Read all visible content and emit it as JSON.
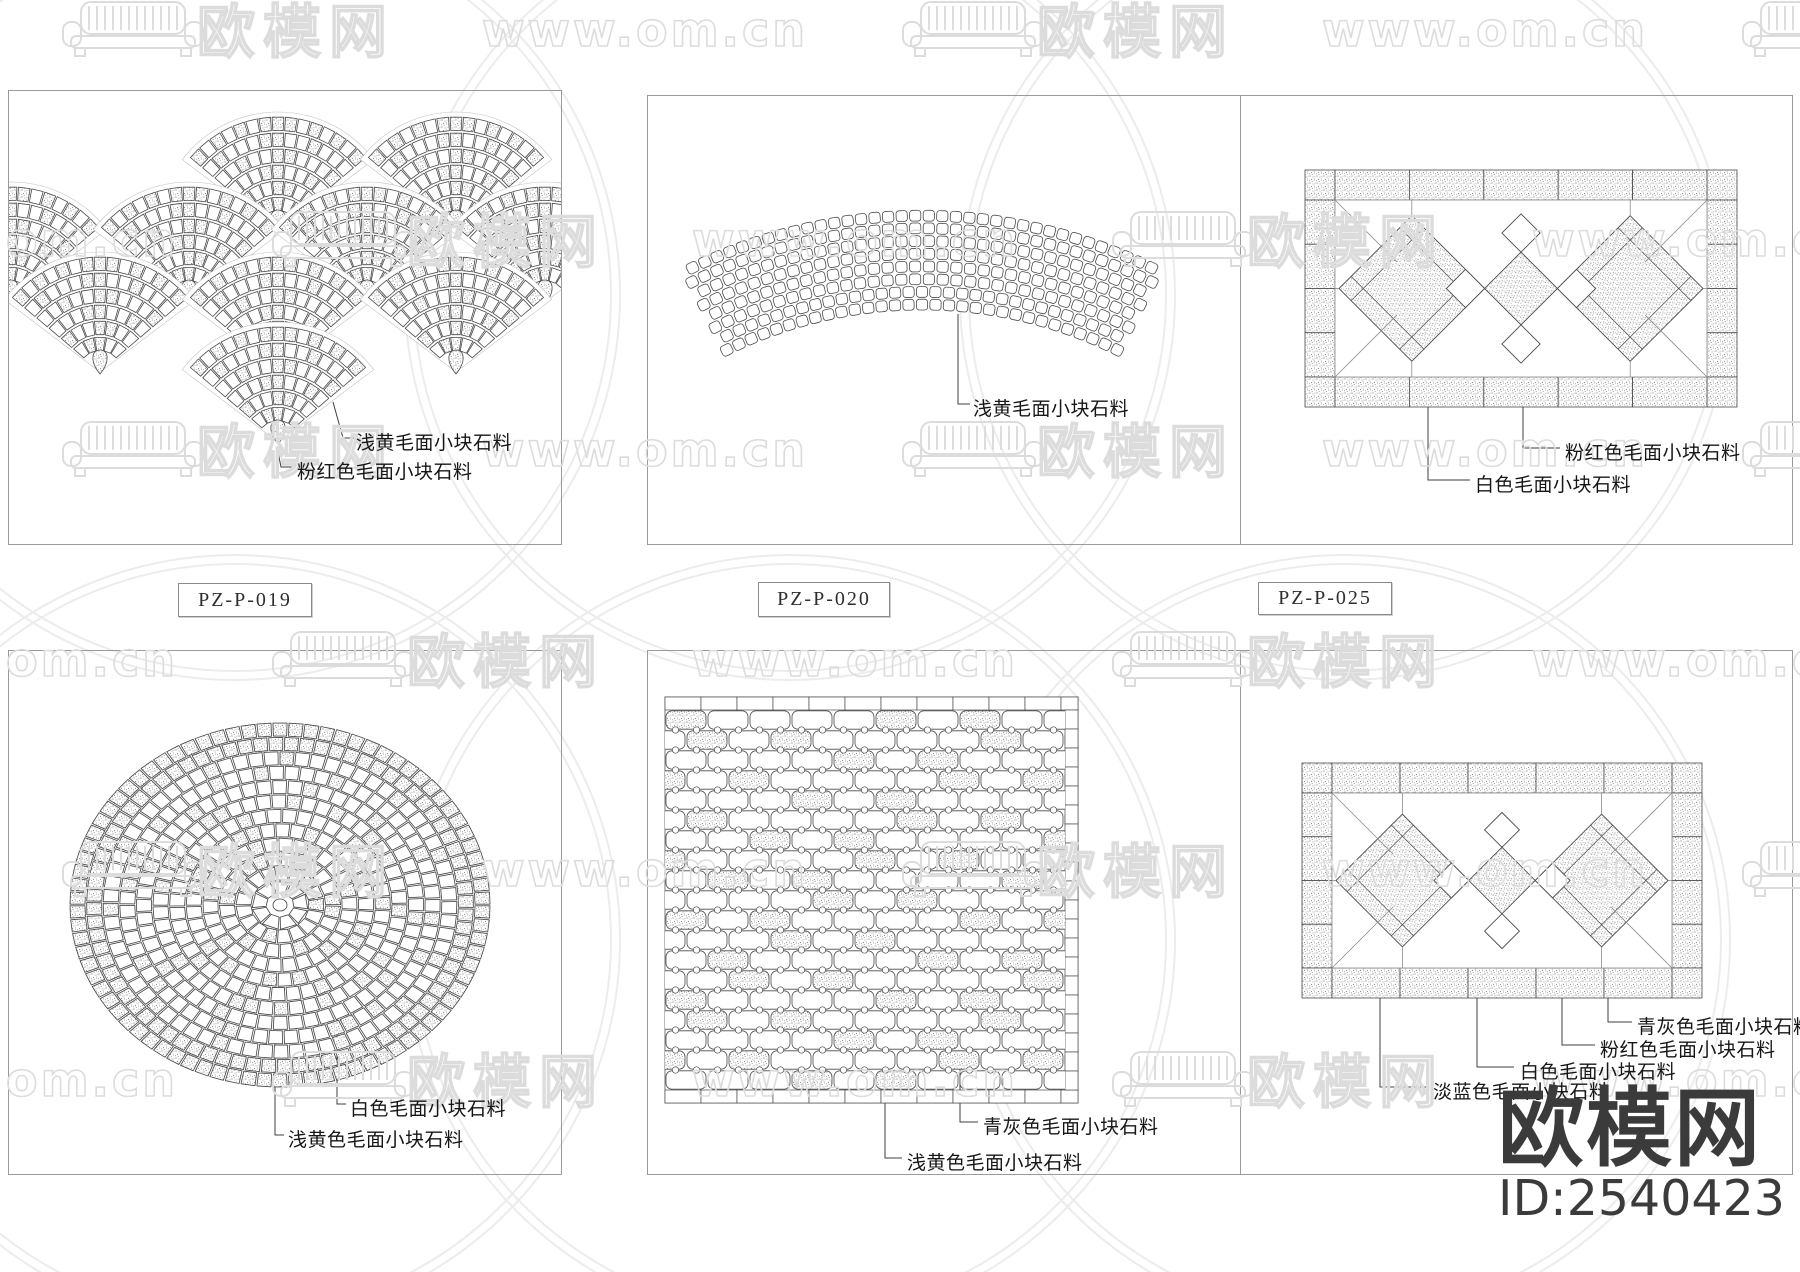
{
  "page": {
    "w": 1800,
    "h": 1272,
    "bg": "#ffffff"
  },
  "colors": {
    "line": "#4a4a4a",
    "thin": "#8a8a8a",
    "label": "#161616",
    "frame": "#9a9a9a",
    "stipple_dot": "#8f8f8f",
    "watermark": "#dcdcdc",
    "arc": "#ececec",
    "logo": "#3b3b3b"
  },
  "watermark": {
    "logo_text": "欧模网",
    "url_text": "www.om.cn",
    "rows_y": [
      30,
      240,
      450,
      660,
      870,
      1080
    ],
    "col_step": 420,
    "even_start": 225,
    "odd_start": 15
  },
  "brand": {
    "logo_text": "欧模网",
    "id_text": "ID:2540423"
  },
  "frames": [
    [
      8,
      90,
      554,
      455
    ],
    [
      647,
      95,
      1146,
      450
    ],
    [
      8,
      650,
      554,
      525
    ],
    [
      647,
      650,
      1146,
      525
    ]
  ],
  "dividers": [
    [
      1240,
      95,
      450
    ],
    [
      1240,
      650,
      525
    ]
  ],
  "code_tags": [
    {
      "text": "PZ-P-019",
      "x": 178,
      "y": 583,
      "w": 132,
      "h": 32
    },
    {
      "text": "PZ-P-020",
      "x": 758,
      "y": 582,
      "w": 130,
      "h": 33
    },
    {
      "text": "PZ-P-025",
      "x": 1258,
      "y": 582,
      "w": 132,
      "h": 31
    }
  ],
  "panels": [
    {
      "name": "fan-scale-paving",
      "frame": 0,
      "fans": {
        "R": 115,
        "spread_deg": 100,
        "rows": [
          {
            "y": 232,
            "xs": [
              278,
              456
            ]
          },
          {
            "y": 302,
            "xs": [
              11,
              189,
              367,
              545
            ]
          },
          {
            "y": 372,
            "xs": [
              100,
              278,
              456
            ]
          },
          {
            "y": 442,
            "xs": [
              278
            ]
          }
        ]
      },
      "labels": [
        {
          "text": "浅黄毛面小块石料",
          "x": 356,
          "y": 428,
          "leader": [
            [
              333,
              402
            ],
            [
              343,
              438
            ],
            [
              354,
              438
            ]
          ]
        },
        {
          "text": "粉红色毛面小块石料",
          "x": 297,
          "y": 457,
          "leader": [
            [
              278,
              452
            ],
            [
              281,
              467
            ],
            [
              295,
              467
            ]
          ]
        }
      ]
    },
    {
      "name": "arc-band-paving",
      "frame": 1,
      "arc": {
        "cx": 922,
        "cy": 748,
        "r_inner": 438,
        "rows": 8,
        "row_step": 12.7,
        "half_angle_deg": 27
      },
      "labels": [
        {
          "text": "浅黄毛面小块石料",
          "x": 973,
          "y": 394,
          "leader": [
            [
              958,
              314
            ],
            [
              958,
              404
            ],
            [
              970,
              404
            ]
          ]
        }
      ]
    },
    {
      "name": "diamond-rect-paving",
      "frame": 1,
      "rect": [
        1305,
        170,
        432,
        237
      ],
      "labels": [
        {
          "text": "粉红色毛面小块石料",
          "x": 1565,
          "y": 438,
          "leader": [
            [
              1523,
              398
            ],
            [
              1523,
              448
            ],
            [
              1560,
              448
            ]
          ]
        },
        {
          "text": "白色毛面小块石料",
          "x": 1475,
          "y": 470,
          "leader": [
            [
              1428,
              372
            ],
            [
              1428,
              480
            ],
            [
              1470,
              480
            ]
          ]
        }
      ]
    },
    {
      "name": "circle-mosaic-paving",
      "frame": 2,
      "circle": {
        "cx": 280,
        "cy": 905,
        "rx": 210,
        "ry": 182
      },
      "labels": [
        {
          "text": "白色毛面小块石料",
          "x": 350,
          "y": 1094,
          "leader": [
            [
              337,
              1018
            ],
            [
              337,
              1104
            ],
            [
              346,
              1104
            ]
          ]
        },
        {
          "text": "浅黄色毛面小块石料",
          "x": 288,
          "y": 1125,
          "leader": [
            [
              275,
              1042
            ],
            [
              275,
              1135
            ],
            [
              284,
              1135
            ]
          ]
        }
      ]
    },
    {
      "name": "interlock-paving",
      "frame": 3,
      "grid": {
        "x": 665,
        "y": 697,
        "w": 413,
        "h": 406
      },
      "labels": [
        {
          "text": "青灰色毛面小块石料",
          "x": 983,
          "y": 1112,
          "leader": [
            [
              960,
              1060
            ],
            [
              960,
              1122
            ],
            [
              978,
              1122
            ]
          ]
        },
        {
          "text": "浅黄色毛面小块石料",
          "x": 907,
          "y": 1148,
          "leader": [
            [
              885,
              1095
            ],
            [
              885,
              1158
            ],
            [
              902,
              1158
            ]
          ]
        }
      ]
    },
    {
      "name": "diamond-rect-paving",
      "frame": 3,
      "rect": [
        1302,
        763,
        400,
        235
      ],
      "labels": [
        {
          "text": "青灰色毛面小块石料",
          "x": 1637,
          "y": 1012,
          "leader": [
            [
              1608,
              972
            ],
            [
              1608,
              1022
            ],
            [
              1632,
              1022
            ]
          ]
        },
        {
          "text": "粉红色毛面小块石料",
          "x": 1600,
          "y": 1035,
          "leader": [
            [
              1562,
              930
            ],
            [
              1562,
              1045
            ],
            [
              1595,
              1045
            ]
          ]
        },
        {
          "text": "白色毛面小块石料",
          "x": 1520,
          "y": 1057,
          "leader": [
            [
              1477,
              898
            ],
            [
              1477,
              1067
            ],
            [
              1514,
              1067
            ]
          ]
        },
        {
          "text": "淡蓝色毛面小块石料",
          "x": 1433,
          "y": 1077,
          "leader": [
            [
              1380,
              872
            ],
            [
              1380,
              1087
            ],
            [
              1428,
              1087
            ]
          ]
        }
      ]
    }
  ],
  "bg_arcs": {
    "centers": [
      [
        235,
        295
      ],
      [
        790,
        295
      ],
      [
        1345,
        295
      ],
      [
        235,
        940
      ],
      [
        790,
        940
      ],
      [
        1345,
        940
      ]
    ],
    "radii": [
      385,
      376
    ]
  }
}
